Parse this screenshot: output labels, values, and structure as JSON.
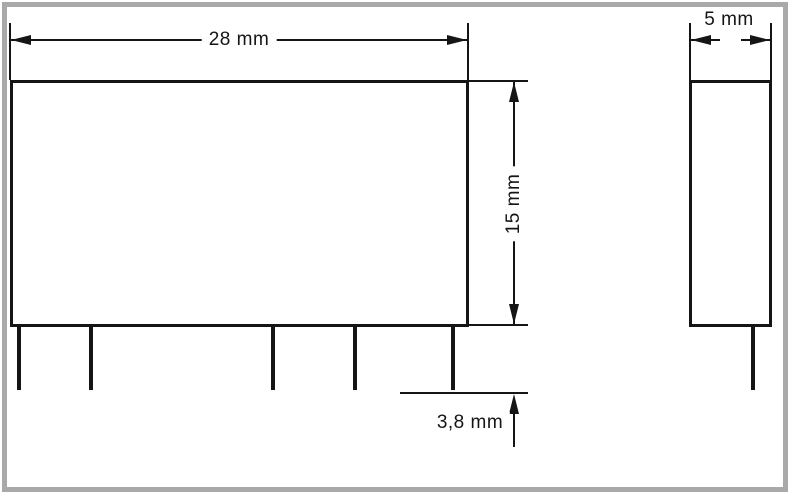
{
  "drawing": {
    "views": {
      "front": {
        "width_label": "28 mm",
        "height_label": "15 mm",
        "pin_length_label": "3,8 mm",
        "pin_count": 5
      },
      "side": {
        "depth_label": "5 mm",
        "pin_count": 1
      }
    },
    "colors": {
      "line": "#151515",
      "frame_border": "#a9a9a9",
      "background": "#ffffff"
    }
  }
}
